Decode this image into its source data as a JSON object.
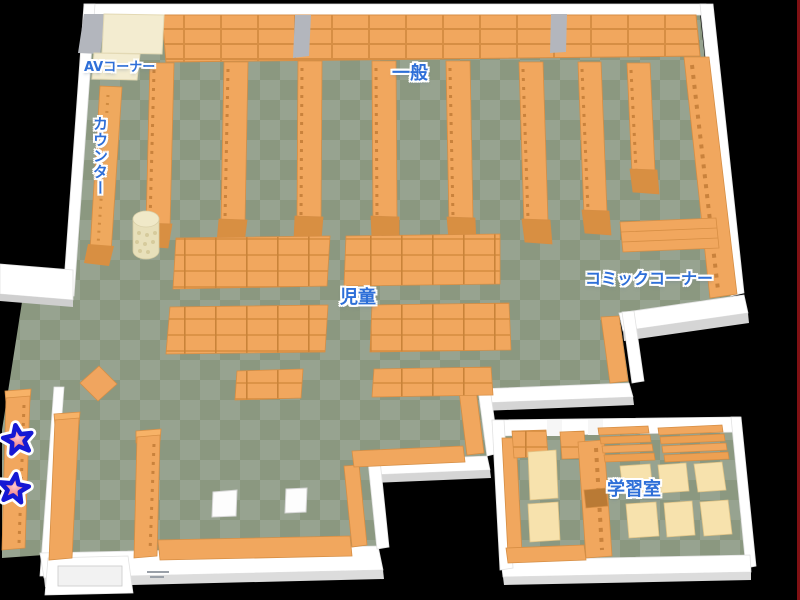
{
  "map": {
    "name": "library-floor-map",
    "floor_style": "checkered"
  },
  "labels": {
    "av_corner": "AVコーナー",
    "general": "一般",
    "counter": "カウンター",
    "children": "児童",
    "comic_corner": "コミックコーナー",
    "study_room": "学習室"
  },
  "markers": [
    {
      "id": "star-1",
      "shape": "star",
      "area": "west-shelf-upper",
      "fill": "#f2868c",
      "outline": "#1518d4"
    },
    {
      "id": "star-2",
      "shape": "star",
      "area": "west-shelf-lower",
      "fill": "#f2868c",
      "outline": "#1518d4"
    }
  ],
  "colors": {
    "background": "#000000",
    "floor_light": "#97a390",
    "floor_dark": "#8b9880",
    "wall": "#ffffff",
    "wall_shade": "#d5d5d5",
    "pillar_gray": "#b3b6bd",
    "shelf_orange": "#f1a75e",
    "shelf_line": "#d68e44",
    "counter_cream": "#f3ecd0",
    "table_cream": "#f7e2ad",
    "label_blue": "#2e6fd8",
    "edge_line_red": "#801114"
  }
}
